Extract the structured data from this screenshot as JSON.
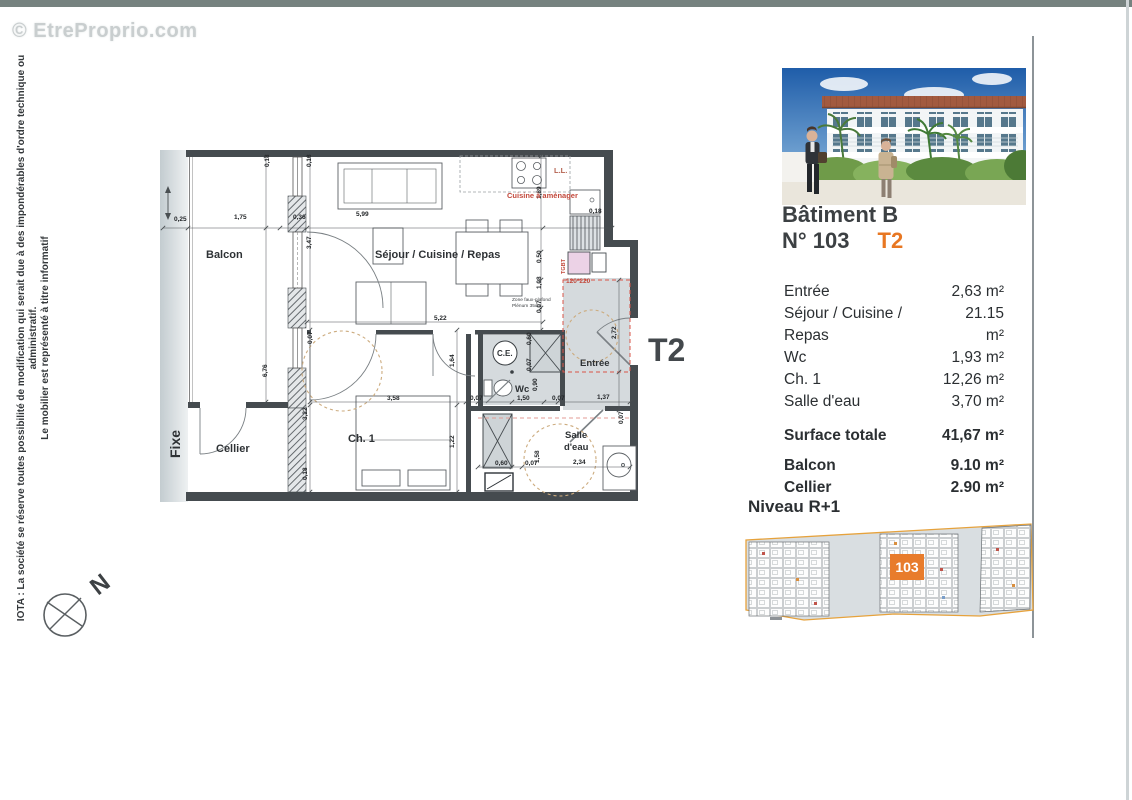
{
  "page": {
    "watermark": "© EtreProprio.com",
    "disclaimer_line1": "IOTA : La société se réserve toutes possibilité de modification qui serait due à des impondérables d'ordre technique ou administratif.",
    "disclaimer_line2": "Le mobilier est représenté à titre informatif",
    "compass_label": "N"
  },
  "plan": {
    "type_label": "T2",
    "rooms": {
      "balcon": "Balcon",
      "cellier": "Cellier",
      "fixe": "Fixe",
      "sejour": "Séjour / Cuisine / Repas",
      "ch1": "Ch. 1",
      "wc": "Wc",
      "ce": "C.E.",
      "entree": "Entrée",
      "sde1": "Salle",
      "sde2": "d'eau"
    },
    "annotations": {
      "cuisine": "Cuisine à aménager",
      "ll": "L.L.",
      "tgbt": "TGBT",
      "door_size": "120*220",
      "zone1": "Zone faux-plafond",
      "zone2": "Plénum 35cm"
    },
    "dim_labels": [
      {
        "t": "0,25",
        "x": 14,
        "y": 81,
        "r": 0
      },
      {
        "t": "1,75",
        "x": 74,
        "y": 79,
        "r": 0
      },
      {
        "t": "0,36",
        "x": 133,
        "y": 79,
        "r": 0
      },
      {
        "t": "5,99",
        "x": 196,
        "y": 76,
        "r": 0
      },
      {
        "t": "0,18",
        "x": 109,
        "y": 27,
        "r": 1
      },
      {
        "t": "0,18",
        "x": 151,
        "y": 27,
        "r": 1
      },
      {
        "t": "3,47",
        "x": 151,
        "y": 109,
        "r": 1
      },
      {
        "t": "6,76",
        "x": 107,
        "y": 237,
        "r": 1
      },
      {
        "t": "1,89",
        "x": 381,
        "y": 59,
        "r": 1
      },
      {
        "t": "0,50",
        "x": 381,
        "y": 123,
        "r": 1
      },
      {
        "t": "1,08",
        "x": 381,
        "y": 149,
        "r": 1
      },
      {
        "t": "0,07",
        "x": 381,
        "y": 173,
        "r": 1
      },
      {
        "t": "0,18",
        "x": 429,
        "y": 73,
        "r": 0
      },
      {
        "t": "5,22",
        "x": 274,
        "y": 180,
        "r": 0
      },
      {
        "t": "2,72",
        "x": 456,
        "y": 199,
        "r": 1
      },
      {
        "t": "1,64",
        "x": 294,
        "y": 227,
        "r": 1
      },
      {
        "t": "0,07",
        "x": 152,
        "y": 204,
        "r": 1
      },
      {
        "t": "3,22",
        "x": 147,
        "y": 280,
        "r": 1
      },
      {
        "t": "0,18",
        "x": 147,
        "y": 340,
        "r": 1
      },
      {
        "t": "3,58",
        "x": 227,
        "y": 260,
        "r": 0
      },
      {
        "t": "1,22",
        "x": 294,
        "y": 308,
        "r": 1
      },
      {
        "t": "0,07",
        "x": 310,
        "y": 260,
        "r": 0
      },
      {
        "t": "1,50",
        "x": 357,
        "y": 260,
        "r": 0
      },
      {
        "t": "0,90",
        "x": 377,
        "y": 251,
        "r": 1
      },
      {
        "t": "0,07",
        "x": 392,
        "y": 260,
        "r": 0
      },
      {
        "t": "1,37",
        "x": 437,
        "y": 259,
        "r": 0
      },
      {
        "t": "0,60",
        "x": 371,
        "y": 205,
        "r": 1
      },
      {
        "t": "0,07",
        "x": 371,
        "y": 231,
        "r": 1
      },
      {
        "t": "0,60",
        "x": 335,
        "y": 325,
        "r": 0
      },
      {
        "t": "0,07",
        "x": 365,
        "y": 325,
        "r": 0
      },
      {
        "t": "1,58",
        "x": 379,
        "y": 323,
        "r": 1
      },
      {
        "t": "2,34",
        "x": 413,
        "y": 324,
        "r": 0
      },
      {
        "t": "0,07",
        "x": 463,
        "y": 284,
        "r": 1
      }
    ]
  },
  "unit": {
    "building": "Bâtiment B",
    "number": "N° 103",
    "type": "T2"
  },
  "areas": {
    "rows": [
      {
        "label": "Entrée",
        "value": "2,63 m²"
      },
      {
        "label": "Séjour / Cuisine / Repas",
        "value": "21.15 m²"
      },
      {
        "label": "Wc",
        "value": "1,93 m²"
      },
      {
        "label": "Ch. 1",
        "value": "12,26 m²"
      },
      {
        "label": "Salle d'eau",
        "value": "3,70 m²"
      }
    ],
    "total_label": "Surface totale",
    "total_value": "41,67 m²",
    "extras": [
      {
        "label": "Balcon",
        "value": "9.10 m²"
      },
      {
        "label": "Cellier",
        "value": "2.90 m²"
      }
    ]
  },
  "level": {
    "title": "Niveau R+1",
    "unit_marker": "103"
  },
  "colors": {
    "accent": "#e87722",
    "marker": "#e87c2c",
    "wall": "#454b4f"
  }
}
